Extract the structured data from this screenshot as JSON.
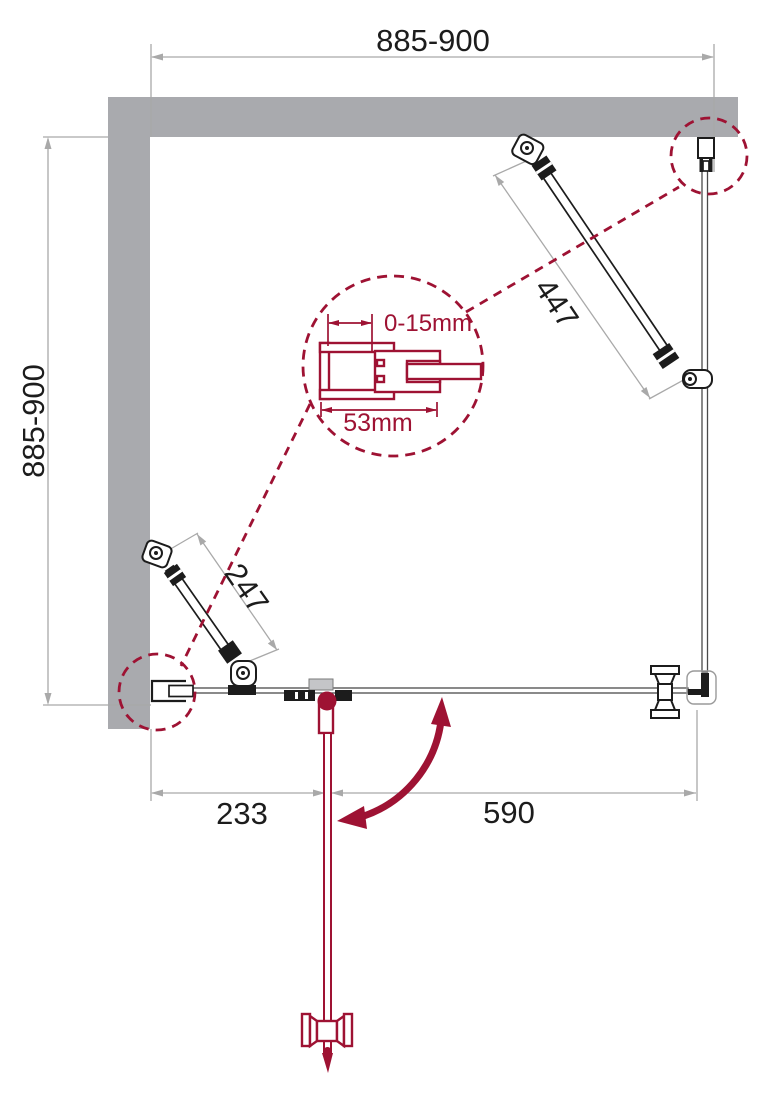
{
  "diagram": {
    "dimensions": {
      "top_width": "885-900",
      "left_height": "885-900",
      "brace_long": "447",
      "brace_short": "247",
      "bottom_left": "233",
      "bottom_right": "590",
      "detail_adjustment": "0-15mm",
      "detail_width": "53mm"
    }
  },
  "colors": {
    "accent": "#9e1233",
    "wall": "#a9aaae",
    "ink": "#1c1c1c",
    "dim": "#a9a9a9",
    "glass": "#4a4a4a",
    "clamp": "#c4c5c8"
  }
}
